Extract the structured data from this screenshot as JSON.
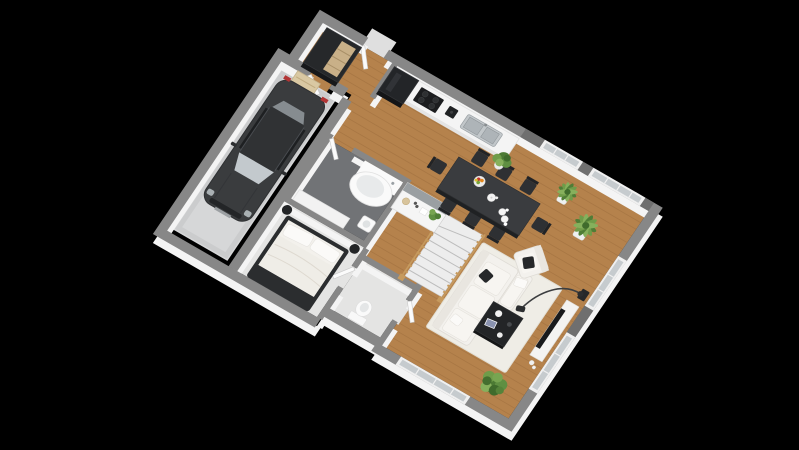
{
  "scene": {
    "type": "3d-floor-plan-render",
    "projection": "isometric",
    "background": "#000000",
    "storey": "ground-floor",
    "label": ""
  },
  "colors": {
    "background": "#000000",
    "wood_floor": "#b5824c",
    "plank_line": "#9c6b3c",
    "garage_floor": "#d6d7d8",
    "bathroom_floor": "#717376",
    "bedroom_floor": "#e4e4e3",
    "wc_floor": "#e4e4e3",
    "wall_cap": "#878787",
    "wall_face": "#f4f4f4",
    "window_glass": "#c6cbce",
    "rug": "#efede6",
    "sofa": "#f3f1ed",
    "dining_table": "#3a3c3f",
    "car_body": "#3a3c3e",
    "stair_wood": "#c69a5e",
    "plant_green": "#5f8f42",
    "dark_furniture": "#26282a"
  },
  "rooms": [
    {
      "id": "entry-hall",
      "floor": "wood",
      "contents": [
        "wardrobe",
        "bench",
        "front-door"
      ]
    },
    {
      "id": "garage",
      "floor": "concrete-grey",
      "contents": [
        "car"
      ]
    },
    {
      "id": "kitchen",
      "floor": "wood",
      "contents": [
        "refrigerator",
        "cooktop",
        "coffee-machine",
        "double-sink",
        "counter-run",
        "peninsula-counter"
      ]
    },
    {
      "id": "bathroom",
      "floor": "dark-tile",
      "contents": [
        "corner-bathtub",
        "washbasin",
        "low-cabinet"
      ]
    },
    {
      "id": "bedroom",
      "floor": "light-grey",
      "contents": [
        "double-bed",
        "pouf",
        "pouf"
      ]
    },
    {
      "id": "wc",
      "floor": "light-grey",
      "contents": [
        "toilet"
      ]
    },
    {
      "id": "living-dining",
      "floor": "wood",
      "contents": [
        "dining-table",
        "dining-chairs",
        "rug",
        "corner-sofa",
        "armchair",
        "coffee-table",
        "tv-console",
        "arc-floor-lamp",
        "speaker",
        "winder-staircase",
        "potted-plants"
      ]
    }
  ],
  "counts": {
    "dining_chairs": 8,
    "windows": 5,
    "plants": 5,
    "doors": 5
  },
  "furniture_details": {
    "car": {
      "color": "dark-grey",
      "orientation": "nose-toward-garage-door"
    },
    "dining_table": {
      "color": "black",
      "items_on_top": [
        "fruit-bowl",
        "teapot",
        "plates",
        "cups"
      ]
    },
    "sofa": {
      "color": "white",
      "pillows": [
        "black",
        "white"
      ]
    },
    "coffee_table": {
      "color": "black",
      "items_on_top": [
        "cup",
        "magazine",
        "bowl"
      ]
    },
    "bed": {
      "frame": "black",
      "bedding": "white"
    },
    "staircase": {
      "treads": "white",
      "railing": "oak"
    }
  }
}
